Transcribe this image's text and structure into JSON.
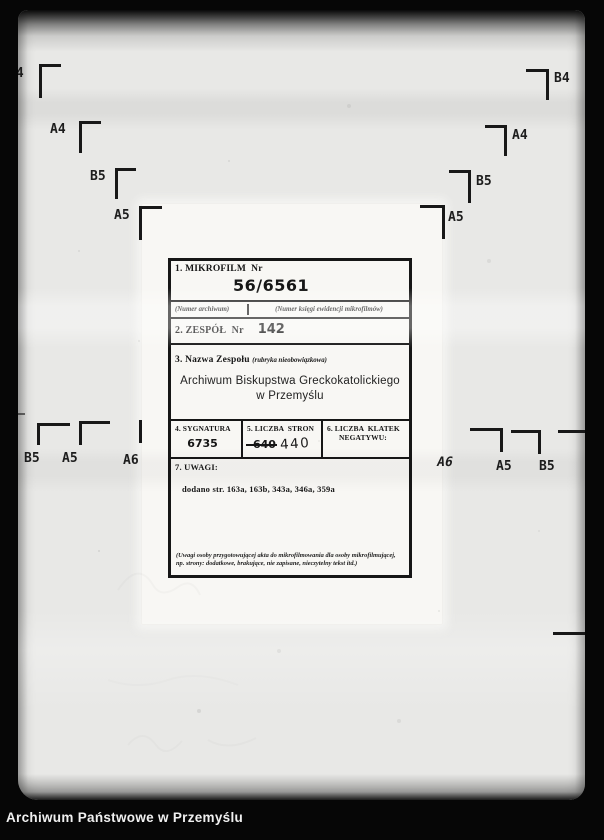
{
  "footer": {
    "label": "Archiwum Państwowe w Przemyślu"
  },
  "film": {
    "marks": {
      "left_stair": [
        "B4",
        "A4",
        "B5",
        "A5"
      ],
      "right_stair": [
        "B4",
        "A4",
        "B5",
        "A5"
      ],
      "left_mid": [
        "B5",
        "A5",
        "A6"
      ],
      "right_mid": [
        "A6",
        "A5",
        "B5"
      ]
    }
  },
  "form": {
    "row1": {
      "label": "1. MIKROFILM  Nr",
      "value": "56/6561",
      "caption_left": "(Numer archiwum)",
      "caption_right": "(Numer księgi ewidencji mikrofilmów)"
    },
    "row2": {
      "label": "2. ZESPÓŁ  Nr",
      "value": "142"
    },
    "row3": {
      "label": "3. Nazwa Zespołu ",
      "label_note": "(rubryka nieobowiązkowa)",
      "value_line1": "Archiwum Biskupstwa Greckokatolickiego",
      "value_line2": "w Przemyślu"
    },
    "row4": {
      "sygnatura_label": "4. SYGNATURA",
      "sygnatura_value": "6735",
      "strony_label": "5. LICZBA  STRON",
      "strony_crossed": "640",
      "strony_value": "440",
      "klatek_label_line1": "6. LICZBA  KLATEK",
      "klatek_label_line2": "NEGATYWU:"
    },
    "row5": {
      "label": "7. UWAGI:",
      "value": "dodano str. 163a, 163b, 343a, 346a, 359a",
      "footnote_line1": "(Uwagi osoby przygotowującej akta do mikrofilmowania dla osoby mikrofilmującej,",
      "footnote_line2": "np. strony: dodatkowe, brakujące, nie zapisane, nieczytelny tekst itd.)"
    }
  },
  "colors": {
    "frame_black": "#060606",
    "film_gray": "#e8e8e6",
    "sheet_white": "#f8f7f4",
    "ink_black": "#161616",
    "footer_text": "#f0f0f0"
  }
}
